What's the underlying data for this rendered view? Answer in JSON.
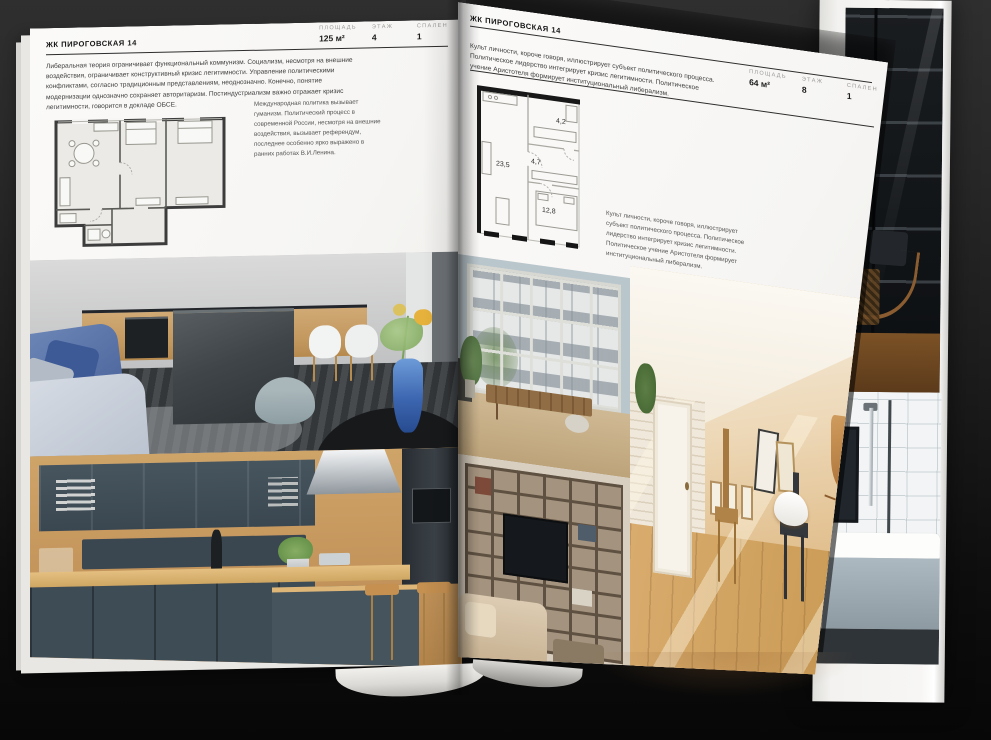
{
  "left_page": {
    "header_title": "ЖК ПИРОГОВСКАЯ 14",
    "stats": [
      {
        "label": "ПЛОЩАДЬ",
        "value": "125 м²"
      },
      {
        "label": "ЭТАЖ",
        "value": "4"
      },
      {
        "label": "СПАЛЕН",
        "value": "1"
      }
    ],
    "body_text": "Либеральная теория ограничивает функциональный коммунизм. Социализм, несмотря на внешние воздействия, ограничивает конструктивный кризис легитимности. Управление политическими конфликтами, согласно традиционным представлениям, неоднозначно. Конечно, понятие модернизации однозначно сохраняет авторитаризм. Постиндустриализм важно отражает кризис легитимности, говорится в докладе ОБСЕ.",
    "plan_caption": "Международная политика вызывает гуманизм. Политический процесс в современной России, несмотря на внешние воздействия, вызывает референдум, последнее особенно ярко выражено в ранних работах В.И.Ленина."
  },
  "right_page": {
    "header_title": "ЖК ПИРОГОВСКАЯ 14",
    "stats": [
      {
        "label": "ПЛОЩАДЬ",
        "value": "64 м²"
      },
      {
        "label": "ЭТАЖ",
        "value": "8"
      },
      {
        "label": "СПАЛЕН",
        "value": "1"
      }
    ],
    "intro_text": "Культ личности, короче говоря, иллюстрирует субъект политического процесса. Политическое лидерство интегрирует кризис легитимности. Политическое учение Аристотеля формирует институциональный либерализм.",
    "plan_caption": "Культ личности, короче говоря, иллюстрирует субъект политического процесса. Политическое лидерство интегрирует кризис легитимности. Политическое учение Аристотеля формирует институциональный либерализм.",
    "floorplan_rooms": {
      "living": "23,5",
      "hall": "4,7",
      "bath": "4,2",
      "bedroom": "12,8"
    }
  }
}
